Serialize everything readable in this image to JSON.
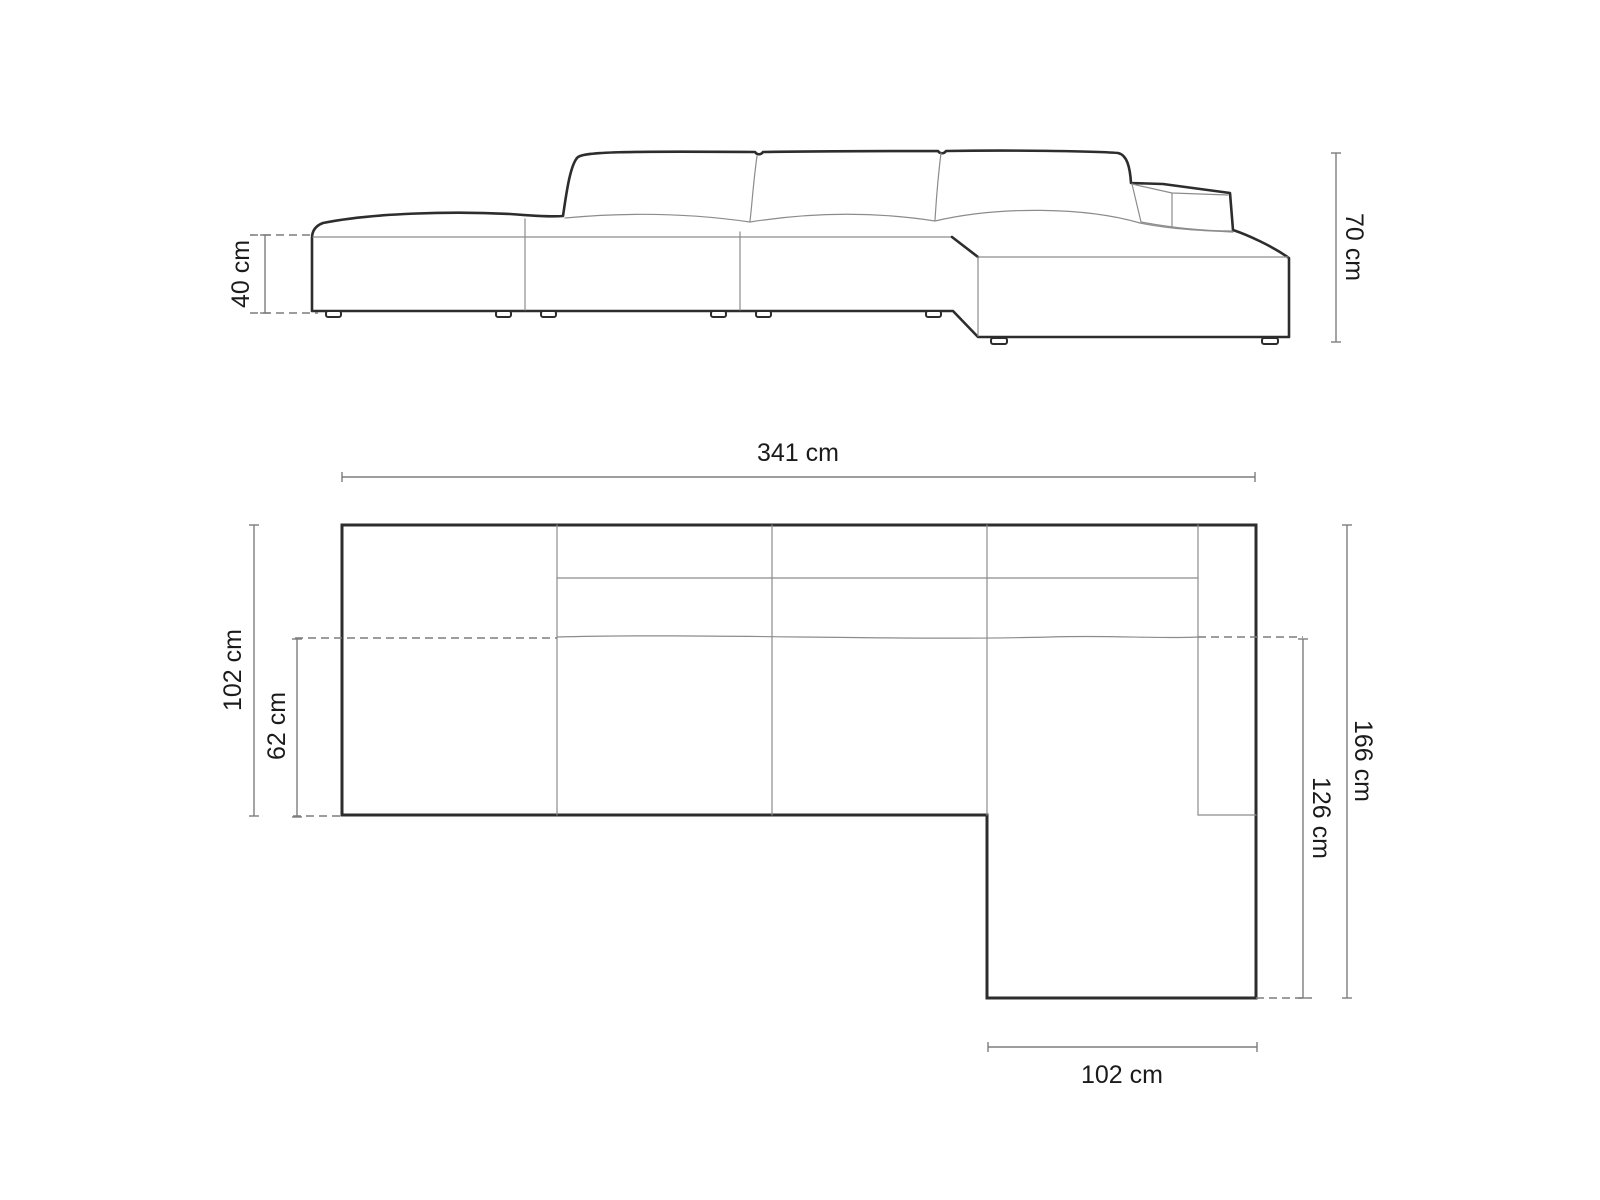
{
  "colors": {
    "outline": "#2d2d2d",
    "seam": "#8c8c8c",
    "dimension": "#7d7d7d",
    "label": "#1b1b1b",
    "background": "#ffffff"
  },
  "unit": "cm",
  "side_view": {
    "name": "sofa side elevation",
    "seat_height": {
      "label": "40 cm",
      "value": 40
    },
    "overall_height": {
      "label": "70 cm",
      "value": 70
    }
  },
  "plan_view": {
    "name": "sofa top plan",
    "overall_width": {
      "label": "341 cm",
      "value": 341
    },
    "overall_depth": {
      "label": "102 cm",
      "value": 102
    },
    "seat_depth": {
      "label": "62 cm",
      "value": 62
    },
    "chaise_overall_depth": {
      "label": "166 cm",
      "value": 166
    },
    "chaise_extension_depth": {
      "label": "126 cm",
      "value": 126
    },
    "chaise_width": {
      "label": "102 cm",
      "value": 102
    }
  }
}
